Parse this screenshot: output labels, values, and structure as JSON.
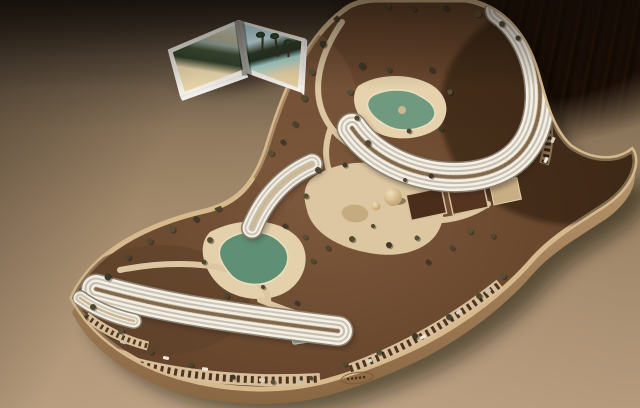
{
  "scene": {
    "setting": "Open travel magazine beside an S-shaped resort architectural scale model on a plywood base, photographed on a dark wooden table over a warm taupe backdrop",
    "magazine": {
      "left_page_photo": "beach cove with resort buildings, vegetation band and sand",
      "right_page_photo": "palm trees on a sandy beach under blue sky"
    },
    "model": {
      "base": "curved plywood slab with beveled edge",
      "hotel_upper": "curved terraced hotel block wrapping the upper lagoon pool",
      "hotel_mid": "stepped terrace block on the hillside",
      "hotel_lower": "long bent terraced hotel block with lagoon pool and lap pool",
      "hotel_tip": "small terraced block at the southwest tip",
      "pools": [
        "upper lagoon pool with island",
        "lower lagoon pool",
        "blue lap pool"
      ],
      "courts": "two sunken sport courts plus one light court",
      "dome": "sand-colored dome pavilion",
      "parking": "perimeter parking rows filled with miniature cars",
      "landscape": "scattered miniature trees, winding sand paths, central sand plaza",
      "stamp": "small oval maker stamp embossed on the front base edge (illegible)"
    },
    "colors": {
      "backdrop_top": "#241e16",
      "backdrop_light": "#ab9172",
      "table_wood": "#1d1008",
      "base_side": "#c2a175",
      "base_rim": "#d6ba8e",
      "terrain": "#6e4c34",
      "path_sand": "#e0cba7",
      "building_white": "#f3f0e8",
      "building_shade": "#c6bcab",
      "roof_tan": "#cdb78f",
      "pool_green": "#6f9a7f",
      "pool_green_dark": "#5f8f74",
      "pool_blue": "#8fc0cc",
      "tree_olive": "#4a4430",
      "court_brown": "#4a2d1b",
      "car_light": "#eee8db",
      "magazine_sky": "#7fc3d8",
      "magazine_sand": "#e8d3a8"
    },
    "trees": [
      [
        336,
        18,
        3
      ],
      [
        323,
        44,
        3.4
      ],
      [
        312,
        72,
        3
      ],
      [
        304,
        98,
        3.4
      ],
      [
        295,
        124,
        3
      ],
      [
        283,
        142,
        2.6
      ],
      [
        271,
        153,
        3
      ],
      [
        388,
        6,
        3
      ],
      [
        414,
        9,
        2.6
      ],
      [
        446,
        8,
        3
      ],
      [
        478,
        14,
        3.4
      ],
      [
        502,
        24,
        3
      ],
      [
        518,
        38,
        2.6
      ],
      [
        362,
        66,
        3.4
      ],
      [
        350,
        92,
        3
      ],
      [
        357,
        118,
        2.6
      ],
      [
        389,
        70,
        2.6
      ],
      [
        432,
        70,
        3
      ],
      [
        450,
        92,
        2.6
      ],
      [
        368,
        143,
        3
      ],
      [
        409,
        131,
        2.4
      ],
      [
        441,
        129,
        2.4
      ],
      [
        549,
        64,
        3
      ],
      [
        561,
        85,
        2.6
      ],
      [
        318,
        170,
        3
      ],
      [
        345,
        165,
        2.5
      ],
      [
        306,
        196,
        2.6
      ],
      [
        352,
        239,
        3
      ],
      [
        328,
        248,
        2.6
      ],
      [
        389,
        245,
        3
      ],
      [
        417,
        238,
        2.5
      ],
      [
        373,
        226,
        2
      ],
      [
        405,
        180,
        2
      ],
      [
        431,
        176,
        2.4
      ],
      [
        470,
        231,
        3
      ],
      [
        493,
        236,
        2.5
      ],
      [
        452,
        248,
        2.5
      ],
      [
        428,
        262,
        2.5
      ],
      [
        503,
        276,
        3
      ],
      [
        479,
        296,
        3
      ],
      [
        449,
        317,
        3
      ],
      [
        415,
        336,
        3
      ],
      [
        379,
        352,
        3
      ],
      [
        345,
        364,
        2.5
      ],
      [
        218,
        208,
        3.4
      ],
      [
        196,
        219,
        3
      ],
      [
        172,
        229,
        3.4
      ],
      [
        150,
        241,
        3
      ],
      [
        128,
        257,
        3
      ],
      [
        108,
        277,
        3.4
      ],
      [
        210,
        240,
        3
      ],
      [
        204,
        262,
        2.5
      ],
      [
        227,
        296,
        2.5
      ],
      [
        285,
        226,
        2.5
      ],
      [
        305,
        237,
        2.5
      ],
      [
        313,
        261,
        2.5
      ],
      [
        263,
        287,
        2
      ],
      [
        297,
        303,
        2.4
      ],
      [
        121,
        331,
        3
      ],
      [
        151,
        352,
        2.5
      ],
      [
        191,
        365,
        2.5
      ],
      [
        233,
        377,
        2.4
      ],
      [
        273,
        382,
        2.4
      ],
      [
        311,
        378,
        2
      ],
      [
        93,
        307,
        3
      ],
      [
        85,
        318,
        2.5
      ]
    ],
    "cars": [
      [
        205,
        369,
        8
      ],
      [
        262,
        380,
        4
      ],
      [
        300,
        382,
        2
      ],
      [
        423,
        337,
        -28
      ],
      [
        459,
        312,
        -32
      ],
      [
        488,
        291,
        -35
      ],
      [
        546,
        160,
        -62
      ],
      [
        553,
        140,
        -66
      ],
      [
        123,
        342,
        18
      ],
      [
        166,
        358,
        12
      ],
      [
        369,
        361,
        -18
      ]
    ]
  }
}
